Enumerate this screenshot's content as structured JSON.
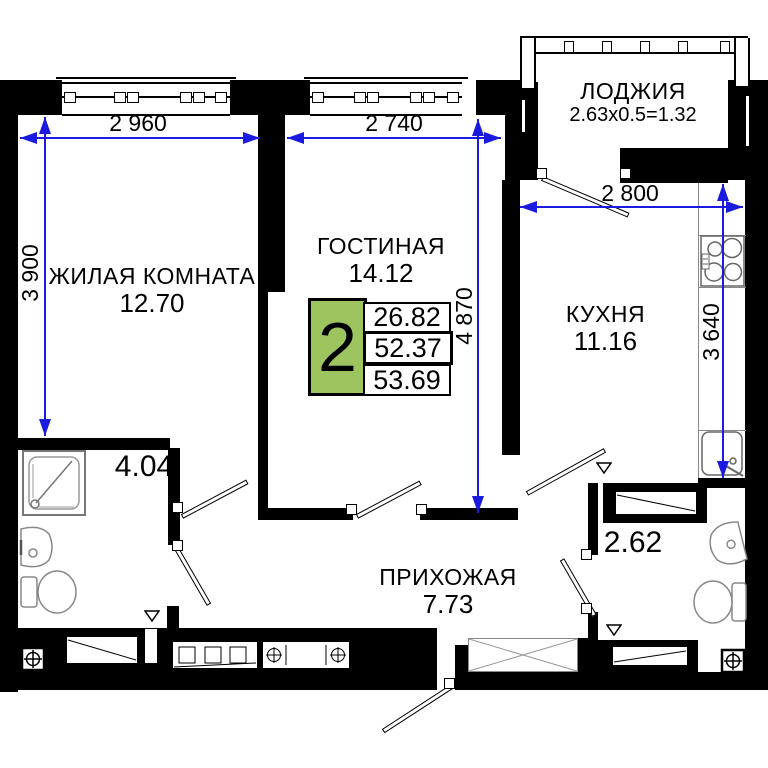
{
  "plan_title": "2-room apartment floor plan",
  "rooms": {
    "living": {
      "name": "ЖИЛАЯ КОМНАТА",
      "area": "12.70"
    },
    "lounge": {
      "name": "ГОСТИНАЯ",
      "area": "14.12"
    },
    "kitchen": {
      "name": "КУХНЯ",
      "area": "11.16"
    },
    "hall": {
      "name": "ПРИХОЖАЯ",
      "area": "7.73"
    },
    "loggia": {
      "name": "ЛОДЖИЯ",
      "formula": "2.63x0.5=1.32"
    },
    "bathroom": {
      "area": "4.04"
    },
    "wc": {
      "area": "2.62"
    }
  },
  "dimensions": {
    "living_width": "2 960",
    "lounge_width": "2 740",
    "living_depth": "3 900",
    "lounge_depth": "4 870",
    "kitchen_width": "2 800",
    "kitchen_depth": "3 640"
  },
  "summary": {
    "rooms_count": "2",
    "living_area": "26.82",
    "apartment_area": "52.37",
    "total_area": "53.69"
  },
  "colors": {
    "wall": "#000000",
    "dimension_blue": "#1a1ae0",
    "summary_green": "#9dc45f"
  }
}
